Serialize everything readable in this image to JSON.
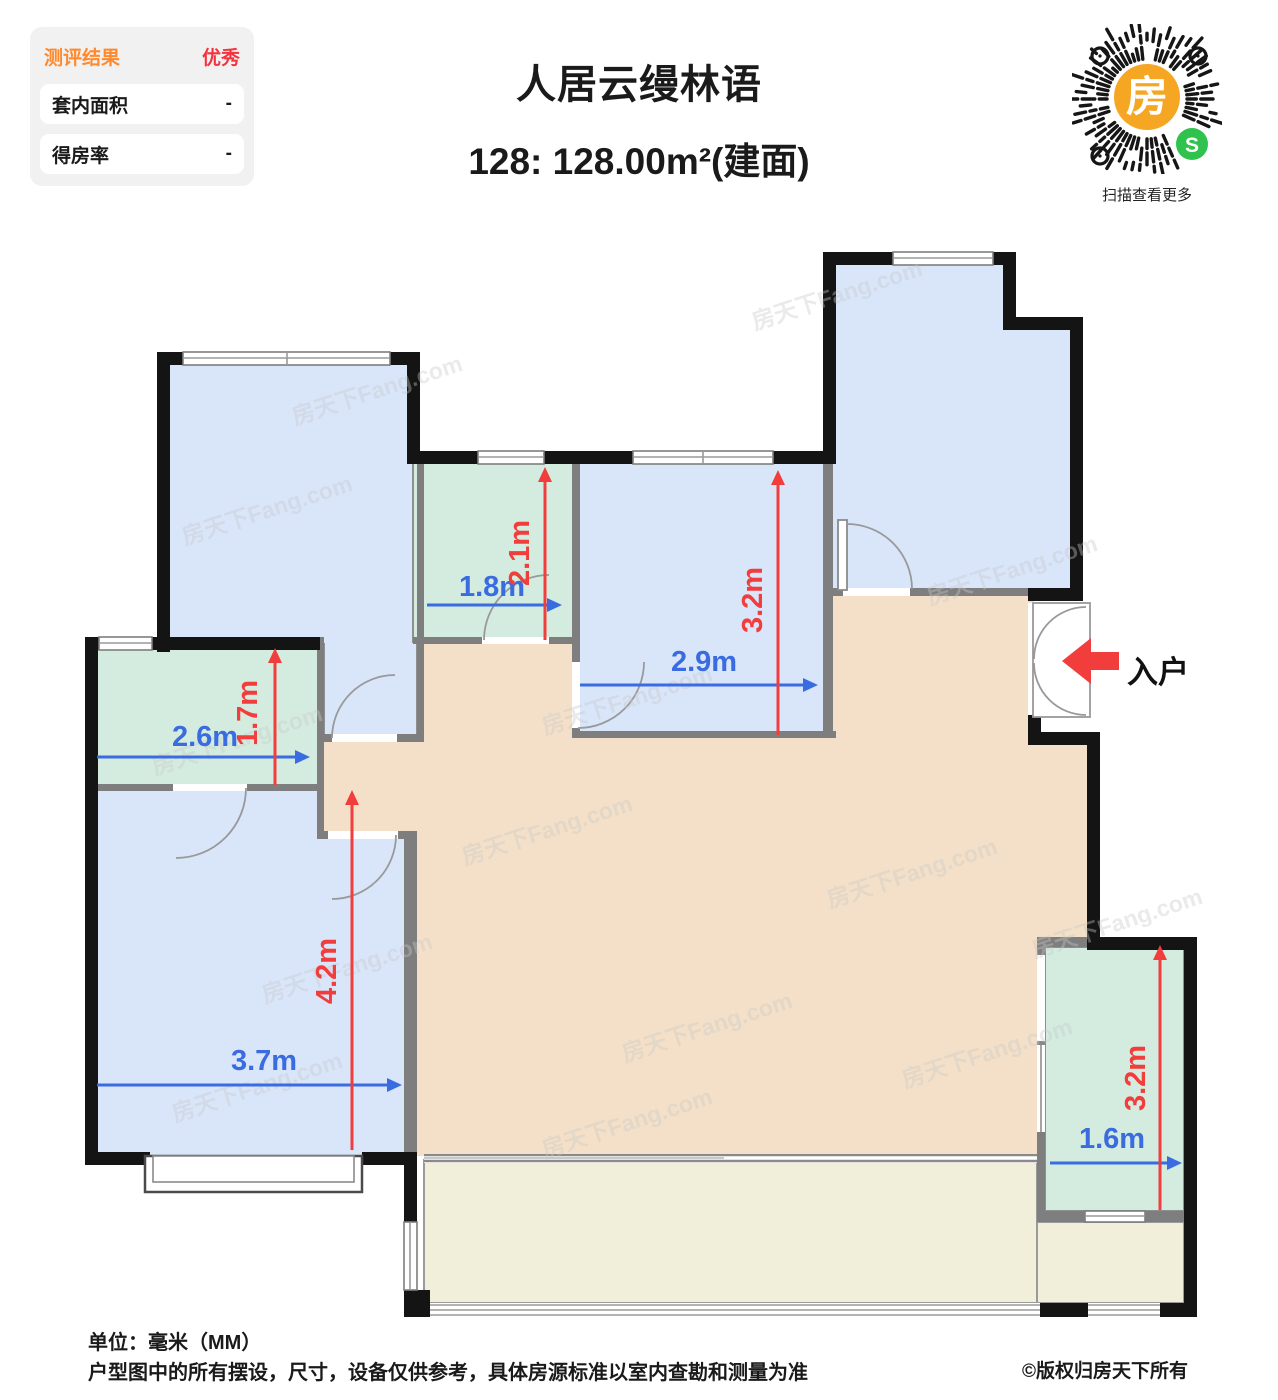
{
  "report_panel": {
    "title": "测评结果",
    "rating": "优秀",
    "rows": [
      {
        "label": "套内面积",
        "value": "-"
      },
      {
        "label": "得房率",
        "value": "-"
      }
    ]
  },
  "header": {
    "project_name": "人居云缦林语",
    "unit_spec": "128: 128.00m²(建面)"
  },
  "qr": {
    "center_glyph": "房",
    "wechat_glyph": "S",
    "caption": "扫描查看更多"
  },
  "plan": {
    "entrance_label": "入户",
    "watermark": "房天下Fang.com",
    "unit": "m",
    "dims": {
      "bath_top_width": "1.8m",
      "bath_top_depth": "2.1m",
      "bedroom_mid_width": "2.9m",
      "bedroom_mid_depth": "3.2m",
      "bath_left_width": "2.6m",
      "bath_left_depth": "1.7m",
      "bedroom_bottom_width": "3.7m",
      "bedroom_bottom_depth": "4.2m",
      "bath_right_width": "1.6m",
      "bath_right_depth": "3.2m"
    },
    "colors": {
      "room_blue": "#d9e6fa",
      "room_green": "#d3ecdf",
      "room_tan": "#f4e0c8",
      "room_yellow": "#f1eed9",
      "wall_black": "#141414",
      "wall_gray": "#7e7e7e",
      "dim_blue": "#3a6be0",
      "dim_red": "#f23d3d",
      "panel_orange": "#ff8a2e",
      "panel_red": "#f4333d"
    }
  },
  "footer": {
    "unit_note": "单位：毫米（MM）",
    "disclaimer": "户型图中的所有摆设，尺寸，设备仅供参考，具体房源标准以室内查勘和测量为准",
    "copyright": "©版权归房天下所有"
  }
}
